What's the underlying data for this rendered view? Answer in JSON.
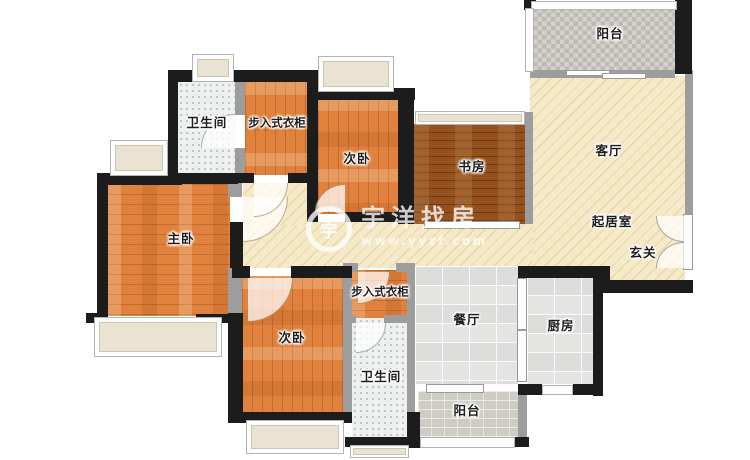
{
  "plan": {
    "type": "apartment-floor-plan",
    "rooms": [
      {
        "id": "balcony-top",
        "label": "阳台"
      },
      {
        "id": "living-room",
        "label": "客厅"
      },
      {
        "id": "sitting-area",
        "label": "起居室"
      },
      {
        "id": "entrance-hall",
        "label": "玄关"
      },
      {
        "id": "study",
        "label": "书房"
      },
      {
        "id": "bedroom-second-top",
        "label": "次卧"
      },
      {
        "id": "walkin-closet-top",
        "label": "步入式衣柜"
      },
      {
        "id": "bathroom-top",
        "label": "卫生间"
      },
      {
        "id": "master-bedroom",
        "label": "主卧"
      },
      {
        "id": "bedroom-second-bottom",
        "label": "次卧"
      },
      {
        "id": "walkin-closet-bottom",
        "label": "步入式衣柜"
      },
      {
        "id": "bathroom-bottom",
        "label": "卫生间"
      },
      {
        "id": "dining-room",
        "label": "餐厅"
      },
      {
        "id": "kitchen",
        "label": "厨房"
      },
      {
        "id": "balcony-bottom",
        "label": "阳台"
      }
    ],
    "watermark": {
      "logo_glyph": "宇",
      "brand": "宇洋找房",
      "url": "www.yyzf.com"
    },
    "colors": {
      "wood": "#e0823d",
      "study_wood": "#94511e",
      "hall_cream": "#f6e9c7",
      "bathroom_tile": "#edf0ed",
      "kitchen_tile": "#e4e4e2",
      "balcony_gray": "#c9c5bf",
      "wall_black": "#1c1c1c",
      "wall_gray": "#9d9d9d",
      "window_fill": "#eae3d1"
    }
  }
}
